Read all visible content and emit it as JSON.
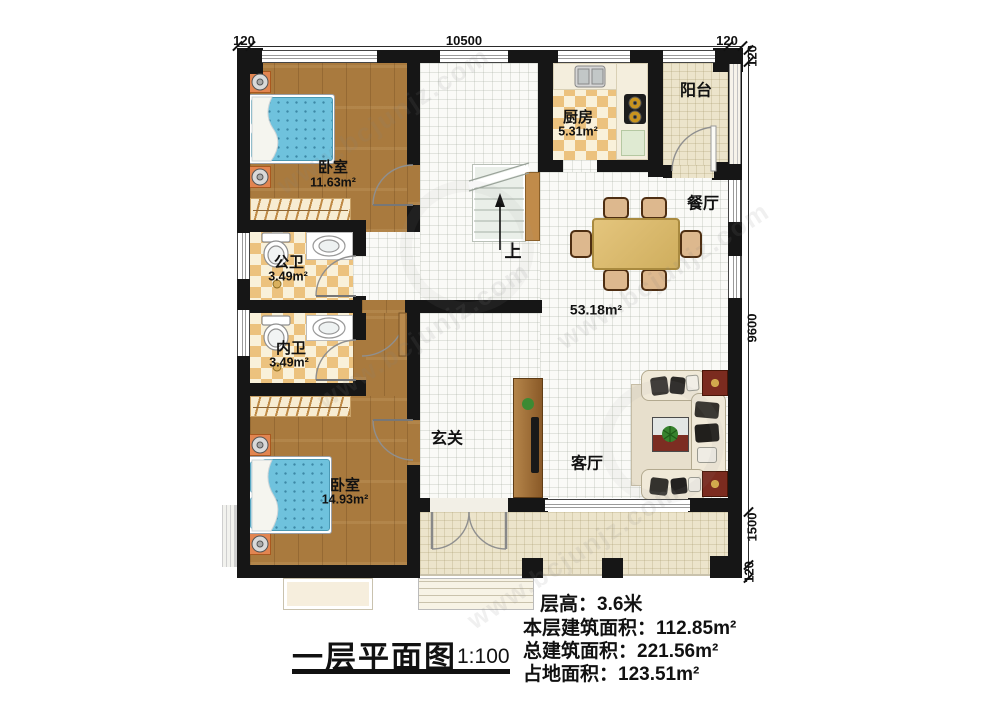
{
  "rooms": {
    "bedroom1": {
      "name": "卧室",
      "area": "11.63m²"
    },
    "bedroom2": {
      "name": "卧室",
      "area": "14.93m²"
    },
    "kitchen": {
      "name": "厨房",
      "area": "5.31m²"
    },
    "balcony": {
      "name": "阳台"
    },
    "dining": {
      "name": "餐厅"
    },
    "living": {
      "name": "客厅"
    },
    "entry": {
      "name": "玄关"
    },
    "public_bath": {
      "name": "公卫",
      "area": "3.49m²"
    },
    "private_bath": {
      "name": "内卫",
      "area": "3.49m²"
    },
    "open_area": {
      "area": "53.18m²"
    },
    "stairs": {
      "up_label": "上"
    }
  },
  "dimensions": {
    "top_left": "120",
    "top_width": "10500",
    "top_right": "120",
    "right_top": "120",
    "right_main": "9600",
    "right_porch": "1500",
    "right_bottom": "120"
  },
  "footer": {
    "title": "一层平面图",
    "scale": "1:100",
    "floor_height": "层高：3.6米",
    "floor_area": "本层建筑面积：112.85m²",
    "total_area": "总建筑面积：221.56m²",
    "land_area": "占地面积：123.51m²"
  },
  "watermark": {
    "text": "www.bcjunjz.com"
  },
  "colors": {
    "wall": "#161616",
    "wood_floor": "#a97a3e",
    "tile_checker": "#ecc27e",
    "mattress": "#6fc2dd",
    "table_wood": "#d9b96a",
    "accent_red": "#7b2b1f"
  }
}
